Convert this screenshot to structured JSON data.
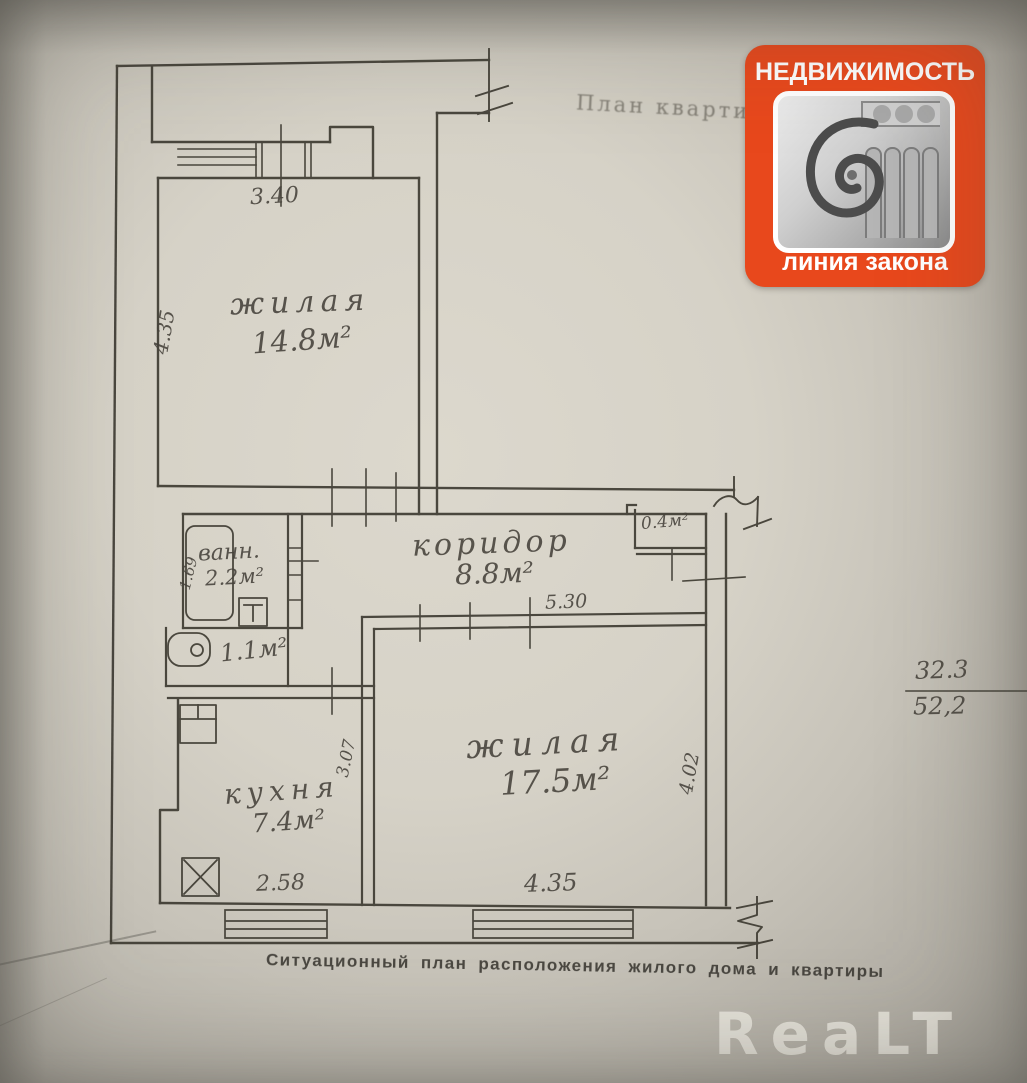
{
  "photo": {
    "title_handwritten": "План квартиры",
    "caption": "Ситуационный план расположения жилого дома и квартиры",
    "watermark": "ReaLT"
  },
  "badge": {
    "title": "НЕДВИЖИМОСТЬ",
    "subtitle": "линия закона",
    "color": "#e8481c",
    "icon": "ionic-column-capital-photo"
  },
  "plan": {
    "rooms": {
      "living1": {
        "label": "жилая",
        "area": "14.8м²"
      },
      "bath": {
        "label": "ванн.",
        "area": "2.2м²"
      },
      "wc": {
        "area": "1.1м²"
      },
      "corridor": {
        "label": "коридор",
        "area": "8.8м²"
      },
      "closet": {
        "area": "0.4м²"
      },
      "living2": {
        "label": "жилая",
        "area": "17.5м²"
      },
      "kitchen": {
        "label": "кухня",
        "area": "7.4м²"
      }
    },
    "dims": {
      "balcony_wall": "3.40",
      "living1_left": "4.35",
      "bath_width": "1.69",
      "corridor_width": "5.30",
      "kitchen_depth": "3.07",
      "living2_right": "4.02",
      "kitchen_width": "2.58",
      "living2_width": "4.35"
    },
    "area_summary": {
      "living_total": "32.3",
      "overall_total": "52,2"
    }
  }
}
